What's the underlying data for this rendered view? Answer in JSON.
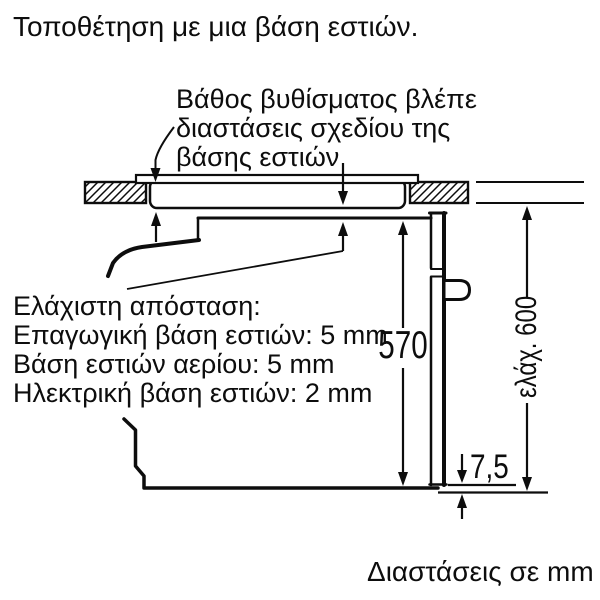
{
  "title": "Τοποθέτηση με μια βάση εστιών.",
  "callout_top": {
    "lines": [
      "Βάθος βυθίσματος βλέπε",
      "διαστάσεις σχεδίου της",
      "βάσης εστιών"
    ]
  },
  "min_distance_note": {
    "lines": [
      "Ελάχιστη απόσταση:",
      "Επαγωγική βάση εστιών: 5 mm",
      "Βάση εστιών αερίου: 5 mm",
      "Ηλεκτρική βάση εστιών: 2 mm"
    ]
  },
  "dimensions": {
    "interior_height": "570",
    "min_total_height": "ελάχ. 600",
    "front_overhang": "7,5"
  },
  "footer_note": "Διαστάσεις σε mm",
  "colors": {
    "line": "#0d0d0d",
    "background": "#ffffff"
  }
}
